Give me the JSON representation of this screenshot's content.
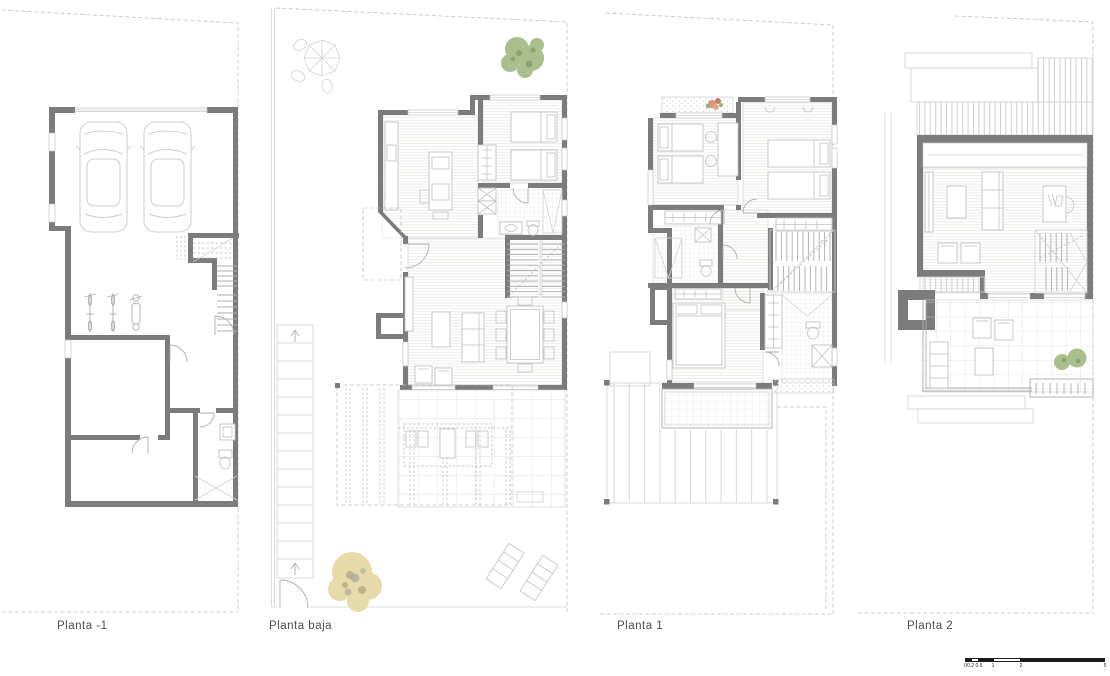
{
  "sheet": {
    "type": "architectural-floor-plans",
    "background": "#ffffff"
  },
  "plans": [
    {
      "id": "planta-minus-1",
      "label": "Planta -1"
    },
    {
      "id": "planta-baja",
      "label": "Planta baja"
    },
    {
      "id": "planta-1",
      "label": "Planta 1"
    },
    {
      "id": "planta-2",
      "label": "Planta 2"
    }
  ],
  "scale_bar": {
    "unit_values": [
      "0",
      "0.2",
      "0.5",
      "1",
      "2",
      "5"
    ]
  },
  "colors": {
    "wall": "#7c7c7c",
    "furniture_line": "#c2c2c4",
    "boundary_dash": "#c2c2c2",
    "floor_hatch": "#e9e7e2",
    "tree_green": "#abbe8e",
    "tree_yellow": "#e7dba9",
    "flowers": "#d89577",
    "label_text": "#4d4d4d",
    "scale_bar": "#1c1c1c"
  }
}
